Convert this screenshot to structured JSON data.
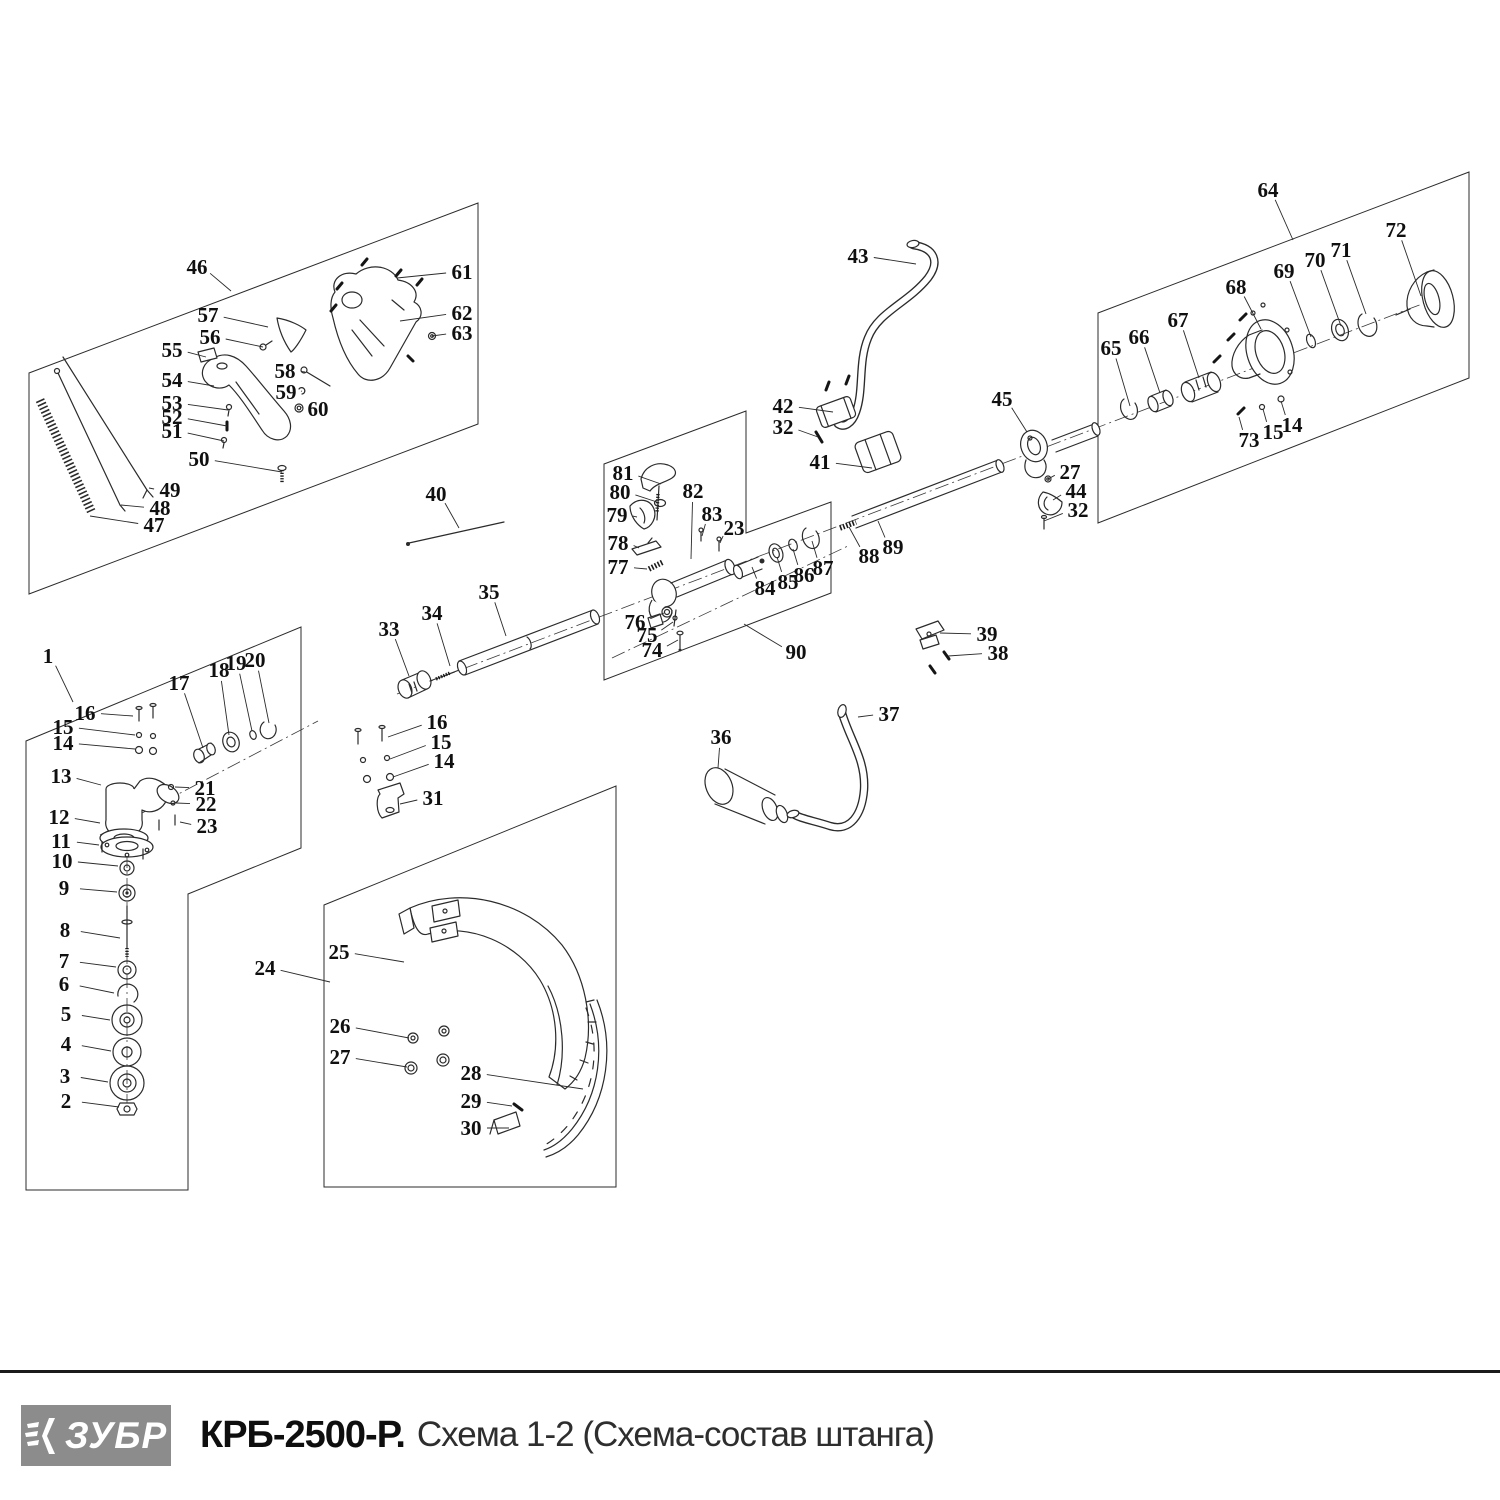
{
  "footer": {
    "logo_text": "ЗУБР",
    "model": "КРБ-2500-Р.",
    "scheme_title": "Схема 1-2 (Схема-состав штанга)"
  },
  "diagram": {
    "part_labels": [
      {
        "n": "46",
        "x": 197,
        "y": 267,
        "tx": 231,
        "ty": 291
      },
      {
        "n": "61",
        "x": 462,
        "y": 272,
        "tx": 397,
        "ty": 278
      },
      {
        "n": "57",
        "x": 208,
        "y": 315,
        "tx": 268,
        "ty": 327
      },
      {
        "n": "62",
        "x": 462,
        "y": 313,
        "tx": 400,
        "ty": 321
      },
      {
        "n": "56",
        "x": 210,
        "y": 337,
        "tx": 263,
        "ty": 347
      },
      {
        "n": "63",
        "x": 462,
        "y": 333,
        "tx": 432,
        "ty": 336
      },
      {
        "n": "55",
        "x": 172,
        "y": 350,
        "tx": 206,
        "ty": 357
      },
      {
        "n": "58",
        "x": 285,
        "y": 371,
        "tx": 305,
        "ty": 372
      },
      {
        "n": "54",
        "x": 172,
        "y": 380,
        "tx": 214,
        "ty": 386
      },
      {
        "n": "59",
        "x": 286,
        "y": 392,
        "tx": 301,
        "ty": 391
      },
      {
        "n": "53",
        "x": 172,
        "y": 403,
        "tx": 228,
        "ty": 410
      },
      {
        "n": "60",
        "x": 318,
        "y": 409,
        "tx": 302,
        "ty": 407
      },
      {
        "n": "52",
        "x": 172,
        "y": 417,
        "tx": 227,
        "ty": 426
      },
      {
        "n": "51",
        "x": 172,
        "y": 431,
        "tx": 224,
        "ty": 441
      },
      {
        "n": "50",
        "x": 199,
        "y": 459,
        "tx": 282,
        "ty": 472
      },
      {
        "n": "49",
        "x": 170,
        "y": 490,
        "tx": 149,
        "ty": 488
      },
      {
        "n": "48",
        "x": 160,
        "y": 508,
        "tx": 121,
        "ty": 505
      },
      {
        "n": "47",
        "x": 154,
        "y": 525,
        "tx": 90,
        "ty": 516
      },
      {
        "n": "40",
        "x": 436,
        "y": 494,
        "tx": 459,
        "ty": 528
      },
      {
        "n": "64",
        "x": 1268,
        "y": 190,
        "tx": 1293,
        "ty": 240
      },
      {
        "n": "72",
        "x": 1396,
        "y": 230,
        "tx": 1421,
        "ty": 296
      },
      {
        "n": "71",
        "x": 1341,
        "y": 250,
        "tx": 1366,
        "ty": 314
      },
      {
        "n": "70",
        "x": 1315,
        "y": 260,
        "tx": 1341,
        "ty": 326
      },
      {
        "n": "69",
        "x": 1284,
        "y": 271,
        "tx": 1311,
        "ty": 337
      },
      {
        "n": "68",
        "x": 1236,
        "y": 287,
        "tx": 1261,
        "ty": 329
      },
      {
        "n": "67",
        "x": 1178,
        "y": 320,
        "tx": 1199,
        "ty": 378
      },
      {
        "n": "66",
        "x": 1139,
        "y": 337,
        "tx": 1160,
        "ty": 393
      },
      {
        "n": "65",
        "x": 1111,
        "y": 348,
        "tx": 1130,
        "ty": 406
      },
      {
        "n": "73",
        "x": 1249,
        "y": 440,
        "tx": 1239,
        "ty": 417
      },
      {
        "n": "15",
        "x": 1273,
        "y": 432,
        "tx": 1263,
        "ty": 409
      },
      {
        "n": "14",
        "x": 1292,
        "y": 425,
        "tx": 1281,
        "ty": 401
      },
      {
        "n": "45",
        "x": 1002,
        "y": 399,
        "tx": 1027,
        "ty": 432
      },
      {
        "n": "27",
        "x": 1070,
        "y": 472,
        "tx": 1048,
        "ty": 479
      },
      {
        "n": "44",
        "x": 1076,
        "y": 491,
        "tx": 1053,
        "ty": 500
      },
      {
        "n": "32",
        "x": 1078,
        "y": 510,
        "tx": 1044,
        "ty": 521
      },
      {
        "n": "43",
        "x": 858,
        "y": 256,
        "tx": 916,
        "ty": 264
      },
      {
        "n": "42",
        "x": 783,
        "y": 406,
        "tx": 833,
        "ty": 412
      },
      {
        "n": "32",
        "x": 783,
        "y": 427,
        "tx": 818,
        "ty": 437
      },
      {
        "n": "41",
        "x": 820,
        "y": 462,
        "tx": 872,
        "ty": 468
      },
      {
        "n": "81",
        "x": 623,
        "y": 473,
        "tx": 661,
        "ty": 484
      },
      {
        "n": "80",
        "x": 620,
        "y": 492,
        "tx": 657,
        "ty": 502
      },
      {
        "n": "79",
        "x": 617,
        "y": 515,
        "tx": 637,
        "ty": 517
      },
      {
        "n": "78",
        "x": 618,
        "y": 543,
        "tx": 639,
        "ty": 548
      },
      {
        "n": "77",
        "x": 618,
        "y": 567,
        "tx": 647,
        "ty": 569
      },
      {
        "n": "82",
        "x": 693,
        "y": 491,
        "tx": 691,
        "ty": 559
      },
      {
        "n": "83",
        "x": 712,
        "y": 514,
        "tx": 702,
        "ty": 536
      },
      {
        "n": "23",
        "x": 734,
        "y": 528,
        "tx": 720,
        "ty": 543
      },
      {
        "n": "84",
        "x": 765,
        "y": 588,
        "tx": 752,
        "ty": 567
      },
      {
        "n": "85",
        "x": 788,
        "y": 582,
        "tx": 777,
        "ty": 557
      },
      {
        "n": "86",
        "x": 804,
        "y": 575,
        "tx": 793,
        "ty": 549
      },
      {
        "n": "87",
        "x": 823,
        "y": 568,
        "tx": 812,
        "ty": 541
      },
      {
        "n": "76",
        "x": 635,
        "y": 622,
        "tx": 664,
        "ty": 613
      },
      {
        "n": "75",
        "x": 647,
        "y": 635,
        "tx": 673,
        "ty": 622
      },
      {
        "n": "74",
        "x": 652,
        "y": 650,
        "tx": 678,
        "ty": 640
      },
      {
        "n": "90",
        "x": 796,
        "y": 652,
        "tx": 744,
        "ty": 624
      },
      {
        "n": "88",
        "x": 869,
        "y": 556,
        "tx": 849,
        "ty": 527
      },
      {
        "n": "89",
        "x": 893,
        "y": 547,
        "tx": 878,
        "ty": 521
      },
      {
        "n": "33",
        "x": 389,
        "y": 629,
        "tx": 409,
        "ty": 676
      },
      {
        "n": "34",
        "x": 432,
        "y": 613,
        "tx": 450,
        "ty": 666
      },
      {
        "n": "35",
        "x": 489,
        "y": 592,
        "tx": 506,
        "ty": 636
      },
      {
        "n": "16",
        "x": 437,
        "y": 722,
        "tx": 388,
        "ty": 737
      },
      {
        "n": "15",
        "x": 441,
        "y": 742,
        "tx": 390,
        "ty": 759
      },
      {
        "n": "14",
        "x": 444,
        "y": 761,
        "tx": 393,
        "ty": 777
      },
      {
        "n": "31",
        "x": 433,
        "y": 798,
        "tx": 400,
        "ty": 804
      },
      {
        "n": "36",
        "x": 721,
        "y": 737,
        "tx": 718,
        "ty": 768
      },
      {
        "n": "37",
        "x": 889,
        "y": 714,
        "tx": 858,
        "ty": 717
      },
      {
        "n": "39",
        "x": 987,
        "y": 634,
        "tx": 940,
        "ty": 633
      },
      {
        "n": "38",
        "x": 998,
        "y": 653,
        "tx": 948,
        "ty": 656
      },
      {
        "n": "24",
        "x": 265,
        "y": 968,
        "tx": 330,
        "ty": 982
      },
      {
        "n": "25",
        "x": 339,
        "y": 952,
        "tx": 404,
        "ty": 962
      },
      {
        "n": "26",
        "x": 340,
        "y": 1026,
        "tx": 409,
        "ty": 1038
      },
      {
        "n": "27",
        "x": 340,
        "y": 1057,
        "tx": 407,
        "ty": 1067
      },
      {
        "n": "28",
        "x": 471,
        "y": 1073,
        "tx": 583,
        "ty": 1089
      },
      {
        "n": "29",
        "x": 471,
        "y": 1101,
        "tx": 512,
        "ty": 1106
      },
      {
        "n": "30",
        "x": 471,
        "y": 1128,
        "tx": 509,
        "ty": 1128
      },
      {
        "n": "1",
        "x": 48,
        "y": 656,
        "tx": 73,
        "ty": 702
      },
      {
        "n": "16",
        "x": 85,
        "y": 713,
        "tx": 133,
        "ty": 716
      },
      {
        "n": "15",
        "x": 63,
        "y": 727,
        "tx": 135,
        "ty": 735
      },
      {
        "n": "14",
        "x": 63,
        "y": 743,
        "tx": 135,
        "ty": 749
      },
      {
        "n": "17",
        "x": 179,
        "y": 683,
        "tx": 203,
        "ty": 748
      },
      {
        "n": "18",
        "x": 219,
        "y": 670,
        "tx": 229,
        "ty": 735
      },
      {
        "n": "19",
        "x": 236,
        "y": 663,
        "tx": 252,
        "ty": 731
      },
      {
        "n": "20",
        "x": 255,
        "y": 660,
        "tx": 269,
        "ty": 723
      },
      {
        "n": "13",
        "x": 61,
        "y": 776,
        "tx": 101,
        "ty": 785
      },
      {
        "n": "21",
        "x": 205,
        "y": 788,
        "tx": 175,
        "ty": 787
      },
      {
        "n": "22",
        "x": 206,
        "y": 804,
        "tx": 176,
        "ty": 803
      },
      {
        "n": "12",
        "x": 59,
        "y": 817,
        "tx": 100,
        "ty": 823
      },
      {
        "n": "23",
        "x": 207,
        "y": 826,
        "tx": 180,
        "ty": 822
      },
      {
        "n": "11",
        "x": 61,
        "y": 841,
        "tx": 99,
        "ty": 845
      },
      {
        "n": "10",
        "x": 62,
        "y": 861,
        "tx": 118,
        "ty": 866
      },
      {
        "n": "9",
        "x": 64,
        "y": 888,
        "tx": 117,
        "ty": 892
      },
      {
        "n": "8",
        "x": 65,
        "y": 930,
        "tx": 120,
        "ty": 938
      },
      {
        "n": "7",
        "x": 64,
        "y": 961,
        "tx": 116,
        "ty": 967
      },
      {
        "n": "6",
        "x": 64,
        "y": 984,
        "tx": 114,
        "ty": 993
      },
      {
        "n": "5",
        "x": 66,
        "y": 1014,
        "tx": 110,
        "ty": 1020
      },
      {
        "n": "4",
        "x": 66,
        "y": 1044,
        "tx": 111,
        "ty": 1051
      },
      {
        "n": "3",
        "x": 65,
        "y": 1076,
        "tx": 108,
        "ty": 1082
      },
      {
        "n": "2",
        "x": 66,
        "y": 1101,
        "tx": 119,
        "ty": 1107
      }
    ]
  }
}
